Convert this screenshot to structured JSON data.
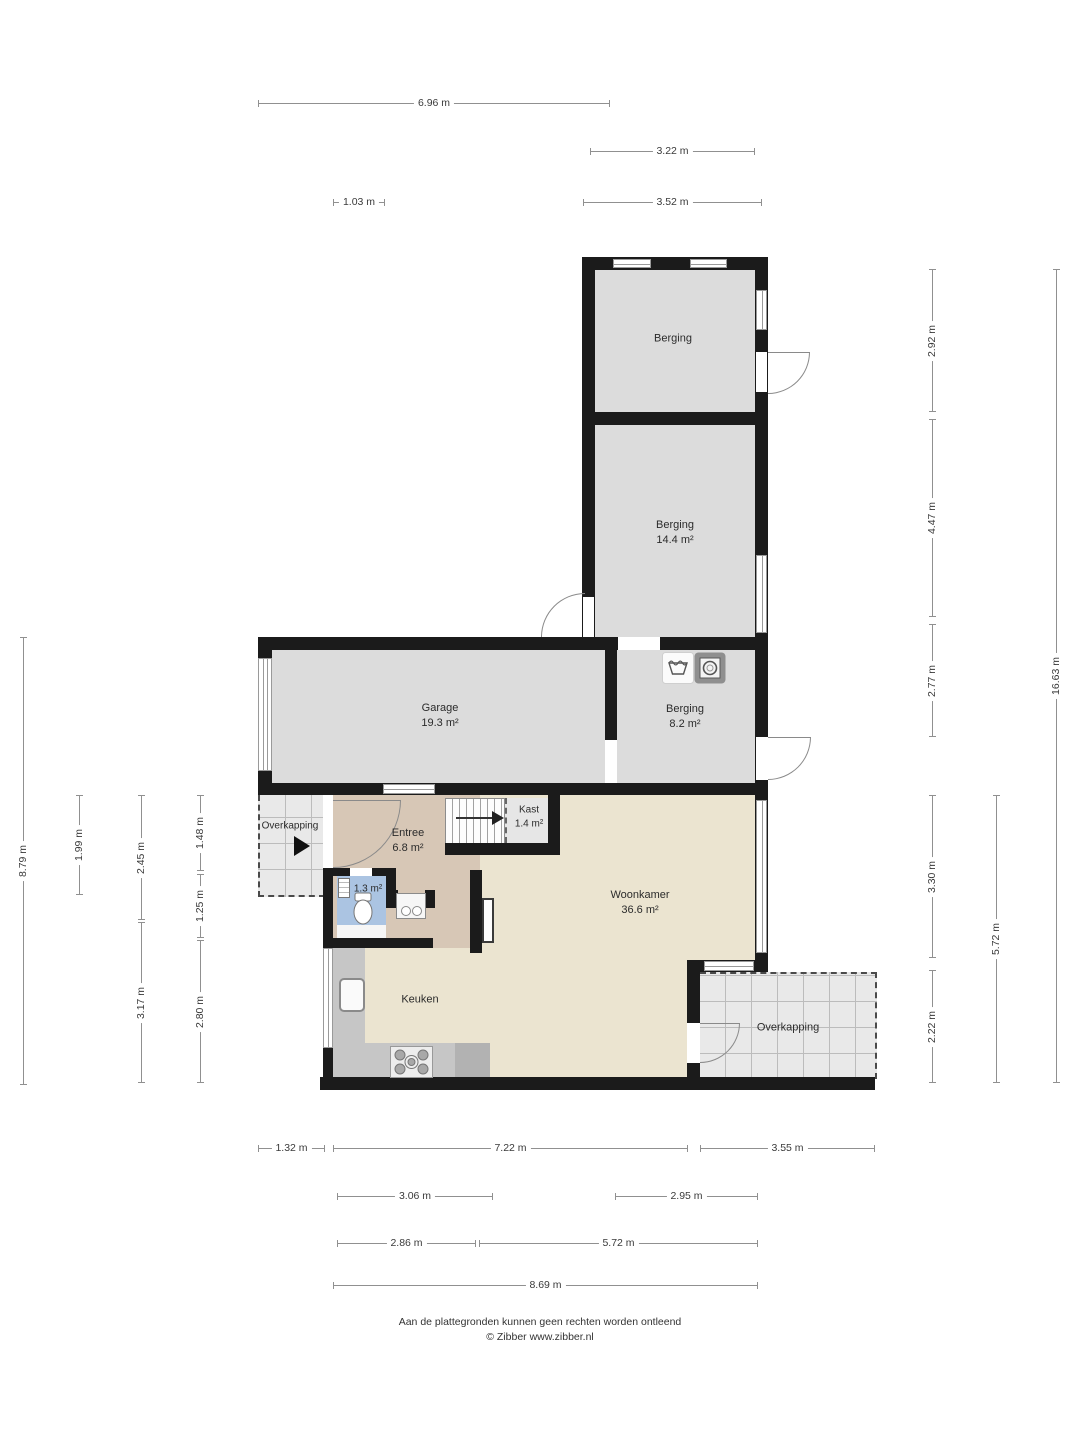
{
  "rooms": {
    "berging_top": {
      "name": "Berging",
      "area": ""
    },
    "berging_mid": {
      "name": "Berging",
      "area": "14.4 m²"
    },
    "garage": {
      "name": "Garage",
      "area": "19.3 m²"
    },
    "berging_small": {
      "name": "Berging",
      "area": "8.2 m²"
    },
    "entree": {
      "name": "Entree",
      "area": "6.8 m²"
    },
    "kast": {
      "name": "Kast",
      "area": "1.4 m²"
    },
    "toilet": {
      "area": "1.3 m²"
    },
    "woonkamer": {
      "name": "Woonkamer",
      "area": "36.6 m²"
    },
    "keuken": {
      "name": "Keuken"
    },
    "overkapping_left": {
      "name": "Overkapping"
    },
    "overkapping_right": {
      "name": "Overkapping"
    }
  },
  "icons": [
    "laundry-basket",
    "washing-machine",
    "toilet",
    "water-heater",
    "washbasin",
    "kitchen-sink",
    "gas-hob",
    "stairs",
    "entrance-arrow"
  ],
  "colors": {
    "wall": "#1b1b1b",
    "room_gray": "#dcdcdc",
    "living_tan": "#ebe4d0",
    "entree_tan": "#d7c7b6",
    "toilet_blue": "#abc4e2",
    "counter_gray": "#c6c6c6",
    "patio_gray": "#e9e9e9"
  },
  "dimensions": [
    {
      "label": "6.96 m",
      "orient": "h",
      "x": 258,
      "y": 103,
      "len": 352
    },
    {
      "label": "3.22 m",
      "orient": "h",
      "x": 590,
      "y": 151,
      "len": 165
    },
    {
      "label": "1.03 m",
      "orient": "h",
      "x": 333,
      "y": 202,
      "len": 52
    },
    {
      "label": "3.52 m",
      "orient": "h",
      "x": 583,
      "y": 202,
      "len": 179
    },
    {
      "label": "2.92 m",
      "orient": "v",
      "x": 932,
      "y": 269,
      "len": 143
    },
    {
      "label": "4.47 m",
      "orient": "v",
      "x": 932,
      "y": 419,
      "len": 198
    },
    {
      "label": "2.77 m",
      "orient": "v",
      "x": 932,
      "y": 624,
      "len": 113
    },
    {
      "label": "3.30 m",
      "orient": "v",
      "x": 932,
      "y": 795,
      "len": 163
    },
    {
      "label": "2.22 m",
      "orient": "v",
      "x": 932,
      "y": 970,
      "len": 113
    },
    {
      "label": "5.72 m",
      "orient": "v",
      "x": 996,
      "y": 795,
      "len": 288
    },
    {
      "label": "16.63 m",
      "orient": "v",
      "x": 1056,
      "y": 269,
      "len": 814
    },
    {
      "label": "8.79 m",
      "orient": "v",
      "x": 23,
      "y": 637,
      "len": 448
    },
    {
      "label": "1.99 m",
      "orient": "v",
      "x": 79,
      "y": 795,
      "len": 100
    },
    {
      "label": "2.45 m",
      "orient": "v",
      "x": 141,
      "y": 795,
      "len": 125
    },
    {
      "label": "3.17 m",
      "orient": "v",
      "x": 141,
      "y": 922,
      "len": 161
    },
    {
      "label": "1.48 m",
      "orient": "v",
      "x": 200,
      "y": 795,
      "len": 76
    },
    {
      "label": "1.25 m",
      "orient": "v",
      "x": 200,
      "y": 874,
      "len": 64
    },
    {
      "label": "2.80 m",
      "orient": "v",
      "x": 200,
      "y": 940,
      "len": 143
    },
    {
      "label": "1.32 m",
      "orient": "h",
      "x": 258,
      "y": 1148,
      "len": 67
    },
    {
      "label": "7.22 m",
      "orient": "h",
      "x": 333,
      "y": 1148,
      "len": 355
    },
    {
      "label": "3.55 m",
      "orient": "h",
      "x": 700,
      "y": 1148,
      "len": 175
    },
    {
      "label": "3.06 m",
      "orient": "h",
      "x": 337,
      "y": 1196,
      "len": 156
    },
    {
      "label": "2.95 m",
      "orient": "h",
      "x": 615,
      "y": 1196,
      "len": 143
    },
    {
      "label": "2.86 m",
      "orient": "h",
      "x": 337,
      "y": 1243,
      "len": 139
    },
    {
      "label": "5.72 m",
      "orient": "h",
      "x": 479,
      "y": 1243,
      "len": 279
    },
    {
      "label": "8.69 m",
      "orient": "h",
      "x": 333,
      "y": 1285,
      "len": 425
    }
  ],
  "footer": {
    "line1": "Aan de plattegronden kunnen geen rechten worden ontleend",
    "line2": "© Zibber www.zibber.nl"
  }
}
